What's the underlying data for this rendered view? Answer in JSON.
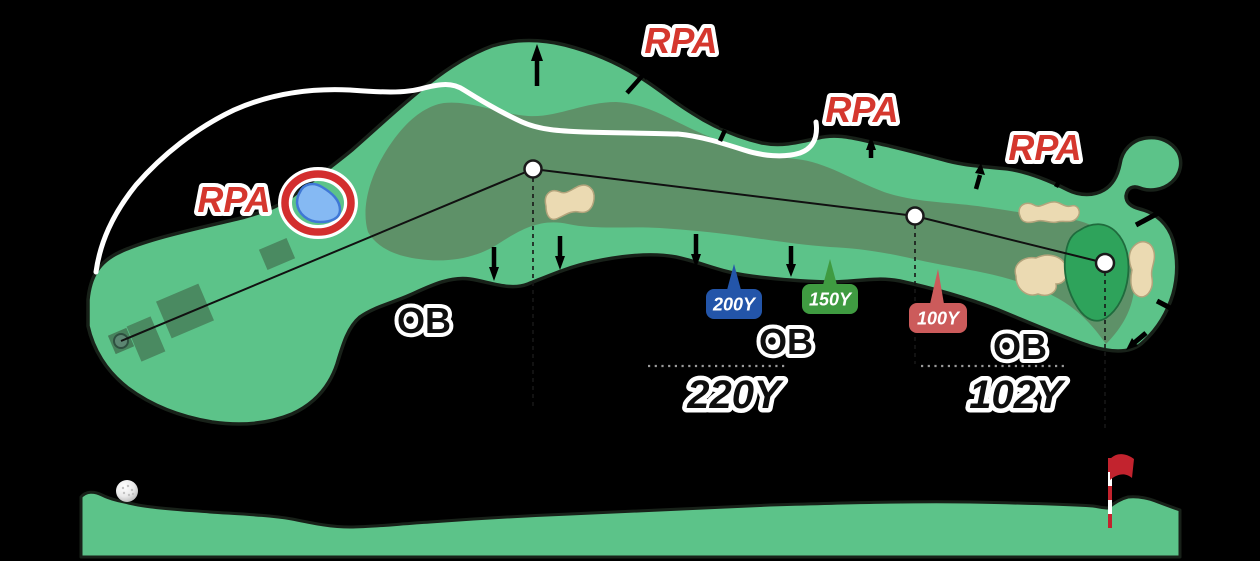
{
  "hole_map": {
    "rpa_labels": [
      "RPA",
      "RPA",
      "RPA",
      "RPA"
    ],
    "ob_labels": [
      "OB",
      "OB",
      "OB"
    ],
    "distance_markers": [
      {
        "label": "200Y",
        "color": "#2355A9"
      },
      {
        "label": "150Y",
        "color": "#3F9B41"
      },
      {
        "label": "100Y",
        "color": "#CC5B5B"
      }
    ],
    "segment_distances": [
      "220Y",
      "102Y"
    ],
    "colors": {
      "rough_green": "#5CC389",
      "fairway_green": "#5E9168",
      "putting_green": "#2EA35B",
      "bunker_sand": "#EBDAB2",
      "water_blue": "#85B9F3",
      "hazard_ring_red": "#D32E2E",
      "rpa_red": "#D5372E",
      "flag_red": "#C2232E",
      "cart_path_white": "#FFFFFF"
    }
  }
}
